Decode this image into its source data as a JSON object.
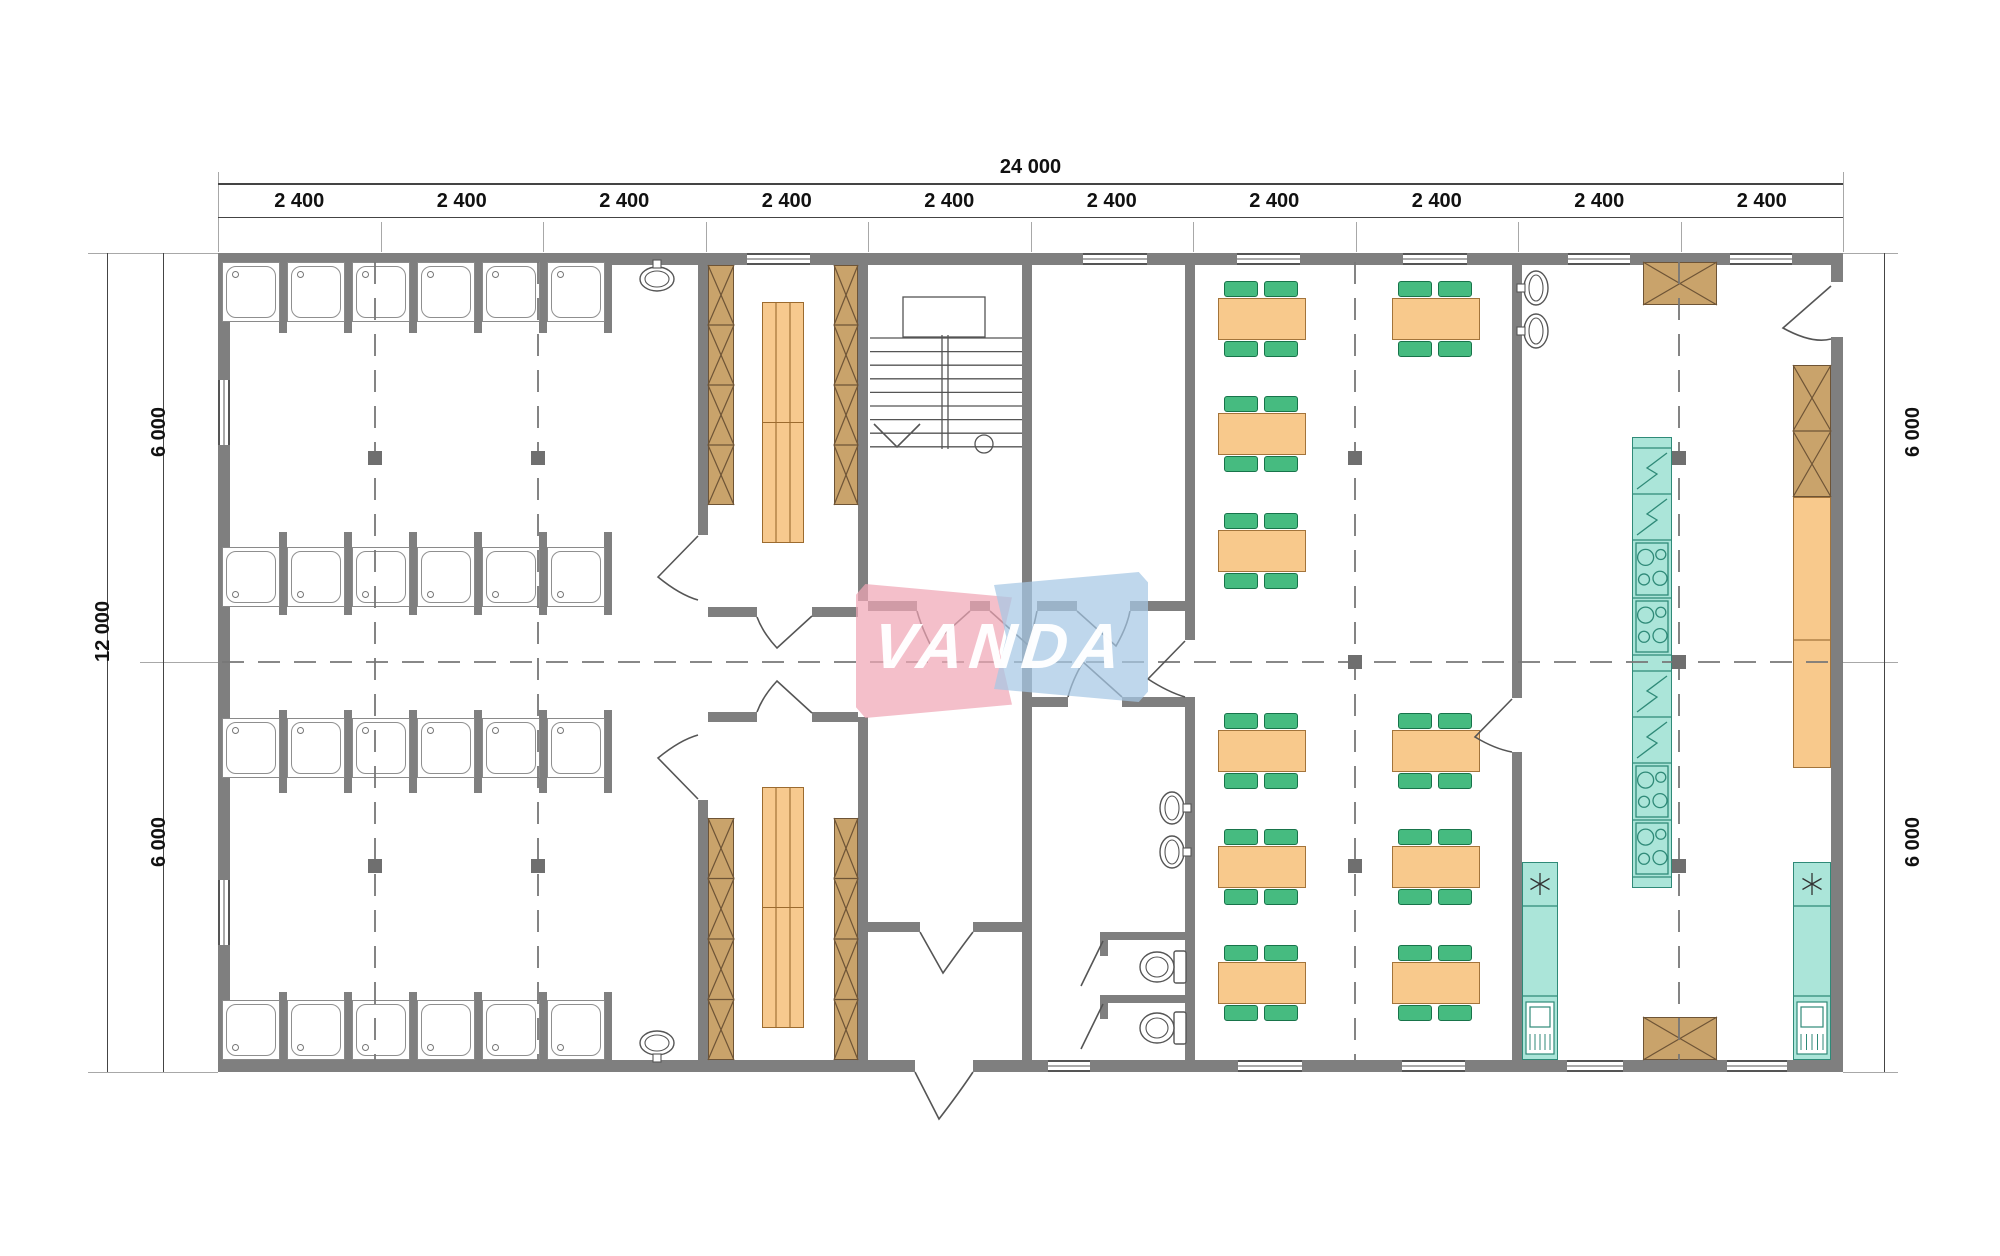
{
  "watermark": {
    "text": "VANDA",
    "pink": "rgba(240,166,182,0.72)",
    "blue": "rgba(166,200,228,0.72)"
  },
  "dims": {
    "top_total": "24 000",
    "top_segments": [
      "2 400",
      "2 400",
      "2 400",
      "2 400",
      "2 400",
      "2 400",
      "2 400",
      "2 400",
      "2 400",
      "2 400"
    ],
    "left_total": "12 000",
    "left_segments": [
      "6 000",
      "6 000"
    ],
    "right_segments": [
      "6 000",
      "6 000"
    ]
  },
  "colors": {
    "wall": "#7f7f7f",
    "line": "#555555",
    "wood": "#c9a36b",
    "wood_dark": "#6e5436",
    "bench": "#f7c98e",
    "bench_dark": "#9c6b2f",
    "table": "#f8c98c",
    "table_dark": "#a3743b",
    "chair": "#46bb80",
    "chair_dark": "#18744a",
    "teal": "#abe5d9",
    "teal_dark": "#2f8a78",
    "column": "#6f6f6f",
    "dim_text": "#111111"
  },
  "plan": {
    "walls": [
      [
        218,
        253,
        1625,
        12
      ],
      [
        218,
        1060,
        1625,
        12
      ],
      [
        218,
        253,
        12,
        819
      ],
      [
        1831,
        253,
        12,
        819
      ],
      [
        698,
        265,
        10,
        270
      ],
      [
        698,
        800,
        10,
        260
      ],
      [
        858,
        265,
        10,
        336
      ],
      [
        858,
        717,
        10,
        343
      ],
      [
        1022,
        265,
        10,
        795
      ],
      [
        1185,
        265,
        10,
        375
      ],
      [
        1185,
        697,
        10,
        363
      ],
      [
        1512,
        265,
        10,
        433
      ],
      [
        1512,
        752,
        10,
        308
      ],
      [
        708,
        607,
        49,
        10
      ],
      [
        812,
        607,
        46,
        10
      ],
      [
        708,
        712,
        49,
        10
      ],
      [
        812,
        712,
        46,
        10
      ],
      [
        868,
        601,
        49,
        10
      ],
      [
        970,
        601,
        20,
        10
      ],
      [
        1037,
        601,
        40,
        10
      ],
      [
        1130,
        601,
        55,
        10
      ],
      [
        1032,
        697,
        36,
        10
      ],
      [
        1122,
        697,
        63,
        10
      ],
      [
        862,
        922,
        58,
        10
      ],
      [
        973,
        922,
        54,
        10
      ],
      [
        1100,
        932,
        85,
        8
      ],
      [
        1100,
        995,
        85,
        8
      ],
      [
        1100,
        940,
        8,
        16
      ],
      [
        1100,
        1003,
        8,
        16
      ]
    ],
    "openings": [
      [
        1831,
        282,
        12,
        55
      ],
      [
        915,
        1060,
        58,
        12
      ]
    ],
    "windows": [
      [
        747,
        253,
        63,
        12,
        "h"
      ],
      [
        1083,
        253,
        64,
        12,
        "h"
      ],
      [
        1237,
        253,
        63,
        12,
        "h"
      ],
      [
        1403,
        253,
        64,
        12,
        "h"
      ],
      [
        1568,
        253,
        62,
        12,
        "h"
      ],
      [
        1730,
        253,
        62,
        12,
        "h"
      ],
      [
        1048,
        1060,
        42,
        12,
        "h"
      ],
      [
        1238,
        1060,
        64,
        12,
        "h"
      ],
      [
        1402,
        1060,
        63,
        12,
        "h"
      ],
      [
        1567,
        1060,
        56,
        12,
        "h"
      ],
      [
        1727,
        1060,
        60,
        12,
        "h"
      ],
      [
        218,
        380,
        12,
        65,
        "v"
      ],
      [
        218,
        880,
        12,
        65,
        "v"
      ]
    ],
    "showers": {
      "xs": [
        222,
        287,
        352,
        417,
        482,
        547
      ],
      "w": 58,
      "h": 60,
      "rows": [
        {
          "y": 262,
          "drain": "top",
          "py": 265,
          "ph": 68
        },
        {
          "y": 547,
          "drain": "bottom",
          "py": 532,
          "ph": 83
        },
        {
          "y": 718,
          "drain": "top",
          "py": 710,
          "ph": 83
        },
        {
          "y": 1000,
          "drain": "bottom",
          "py": 992,
          "ph": 68
        }
      ],
      "part_xs": [
        279,
        344,
        409,
        474,
        539,
        604
      ]
    },
    "wardrobes": [
      [
        708,
        265,
        26,
        240,
        4
      ],
      [
        834,
        265,
        24,
        240,
        4
      ],
      [
        708,
        818,
        26,
        242,
        4
      ],
      [
        834,
        818,
        24,
        242,
        4
      ],
      [
        1793,
        365,
        38,
        132,
        2
      ]
    ],
    "hoods": [
      [
        1643,
        262,
        74,
        43
      ],
      [
        1643,
        1017,
        74,
        43
      ]
    ],
    "benches": [
      [
        762,
        302,
        42,
        241
      ],
      [
        762,
        787,
        42,
        241
      ]
    ],
    "orange_cabinet": [
      1793,
      497,
      38,
      271
    ],
    "appliance_column": {
      "x": 1632,
      "y": 437,
      "w": 40,
      "sections": [
        "cap:11",
        "fridge:46",
        "fridge:46",
        "stove:58",
        "stove:57",
        "plain:16",
        "fridge:46",
        "fridge:46",
        "stove:57",
        "stove:57",
        "cap:11"
      ]
    },
    "sink_units": [
      [
        1522,
        862,
        36,
        198
      ],
      [
        1793,
        862,
        38,
        198
      ]
    ],
    "tables": {
      "w": 88,
      "h": 42,
      "chair_w": 34,
      "chair_h": 16,
      "pos": [
        [
          1218,
          298
        ],
        [
          1218,
          413
        ],
        [
          1218,
          530
        ],
        [
          1218,
          730
        ],
        [
          1218,
          846
        ],
        [
          1218,
          962
        ],
        [
          1392,
          298
        ],
        [
          1392,
          730
        ],
        [
          1392,
          846
        ],
        [
          1392,
          962
        ]
      ]
    },
    "columns": [
      [
        375,
        458
      ],
      [
        538,
        458
      ],
      [
        375,
        866
      ],
      [
        538,
        866
      ],
      [
        1355,
        458
      ],
      [
        1355,
        662
      ],
      [
        1355,
        866
      ],
      [
        1679,
        458
      ],
      [
        1679,
        662
      ],
      [
        1679,
        866
      ]
    ],
    "centerlines": {
      "h": [
        [
          222,
          662,
          1843
        ]
      ],
      "v": [
        [
          375,
          262,
          1060
        ],
        [
          538,
          262,
          1060
        ],
        [
          1355,
          262,
          1060
        ],
        [
          1679,
          262,
          1060
        ]
      ]
    },
    "doors": [
      "M 1831 286 L 1783 328 Q 1812 344 1831 339",
      "M 915 1072 L 939 1119 Q 959 1093 973 1072",
      "M 920 932 L 943 973 Q 960 949 973 932",
      "M 970 611 L 931 646 Q 921 626 917 611",
      "M 990 611 L 1029 646 Q 1034 625 1037 611",
      "M 1077 611 L 1116 646 Q 1127 627 1130 611",
      "M 1122 697 L 1083 662 Q 1072 681 1068 697",
      "M 1185 641 L 1148 679 Q 1168 692 1185 697",
      "M 1512 699 L 1475 737 Q 1495 749 1512 752",
      "M 698 536 L 658 577 Q 680 595 698 600",
      "M 698 799 L 658 758 Q 680 740 698 735",
      "M 812 616 L 777 648 Q 763 633 757 617",
      "M 812 713 L 777 681 Q 763 696 757 712",
      "M 1103 941 L 1081 986",
      "M 1103 1004 L 1081 1049"
    ],
    "stairs": {
      "landing": [
        903,
        297,
        82,
        40
      ],
      "treads": {
        "x1": 870,
        "x2": 1022,
        "y": 338,
        "n": 9,
        "dy": 13.6
      },
      "stringer": {
        "x1": 942,
        "x2": 948,
        "y1": 335,
        "y2": 449
      },
      "arrow": "M 874 424 L 897 447 L 920 424",
      "circle": [
        984,
        444,
        9
      ]
    },
    "basins": [
      {
        "cx": 657,
        "cy": 279,
        "rx": 17,
        "ry": 12,
        "tap": "top"
      },
      {
        "cx": 657,
        "cy": 1043,
        "rx": 17,
        "ry": 12,
        "tap": "bottom"
      },
      {
        "cx": 1172,
        "cy": 808,
        "rx": 12,
        "ry": 16,
        "tap": "right"
      },
      {
        "cx": 1172,
        "cy": 852,
        "rx": 12,
        "ry": 16,
        "tap": "right"
      },
      {
        "cx": 1536,
        "cy": 288,
        "rx": 12,
        "ry": 17,
        "tap": "left"
      },
      {
        "cx": 1536,
        "cy": 331,
        "rx": 12,
        "ry": 17,
        "tap": "left"
      }
    ],
    "toilets": [
      [
        1140,
        949
      ],
      [
        1140,
        1010
      ]
    ],
    "dim_geo": {
      "top_ticks": [
        218,
        380.5,
        543,
        705.5,
        868,
        1030.5,
        1193,
        1355.5,
        1518,
        1680.5,
        1843
      ],
      "overall_line_y": 183,
      "seg_line_y": 217,
      "left_outer_x": 107,
      "left_inner_x": 163,
      "right_x": 1884,
      "v_ticks": [
        253,
        662,
        1072
      ]
    }
  }
}
